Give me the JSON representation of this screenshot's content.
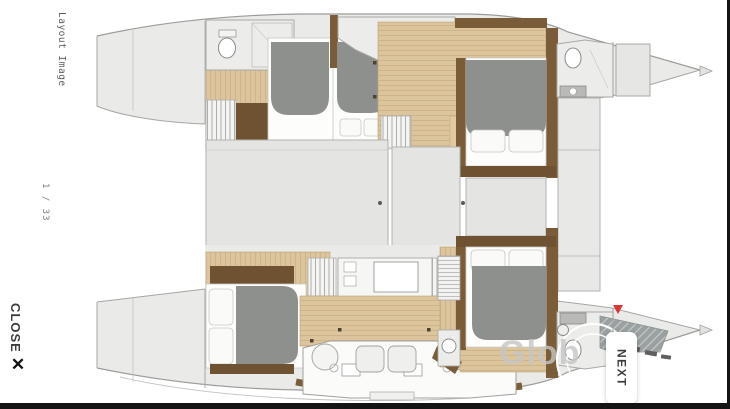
{
  "viewer": {
    "title": "Layout Image",
    "page_counter": "1 / 33",
    "close_label": "CLOSE",
    "close_icon": "✕",
    "next_label": "NEXT",
    "watermark": "Glob"
  },
  "palette": {
    "chrome_black": "#141414",
    "hull_gray": "#eaeae8",
    "panel_gray": "#e4e4e2",
    "wood_light": "#dcc49c",
    "wood_dark": "#6e5231",
    "wall_brown": "#7b5c38",
    "bed_gray": "#8e908e",
    "marker_red": "#d93636"
  }
}
